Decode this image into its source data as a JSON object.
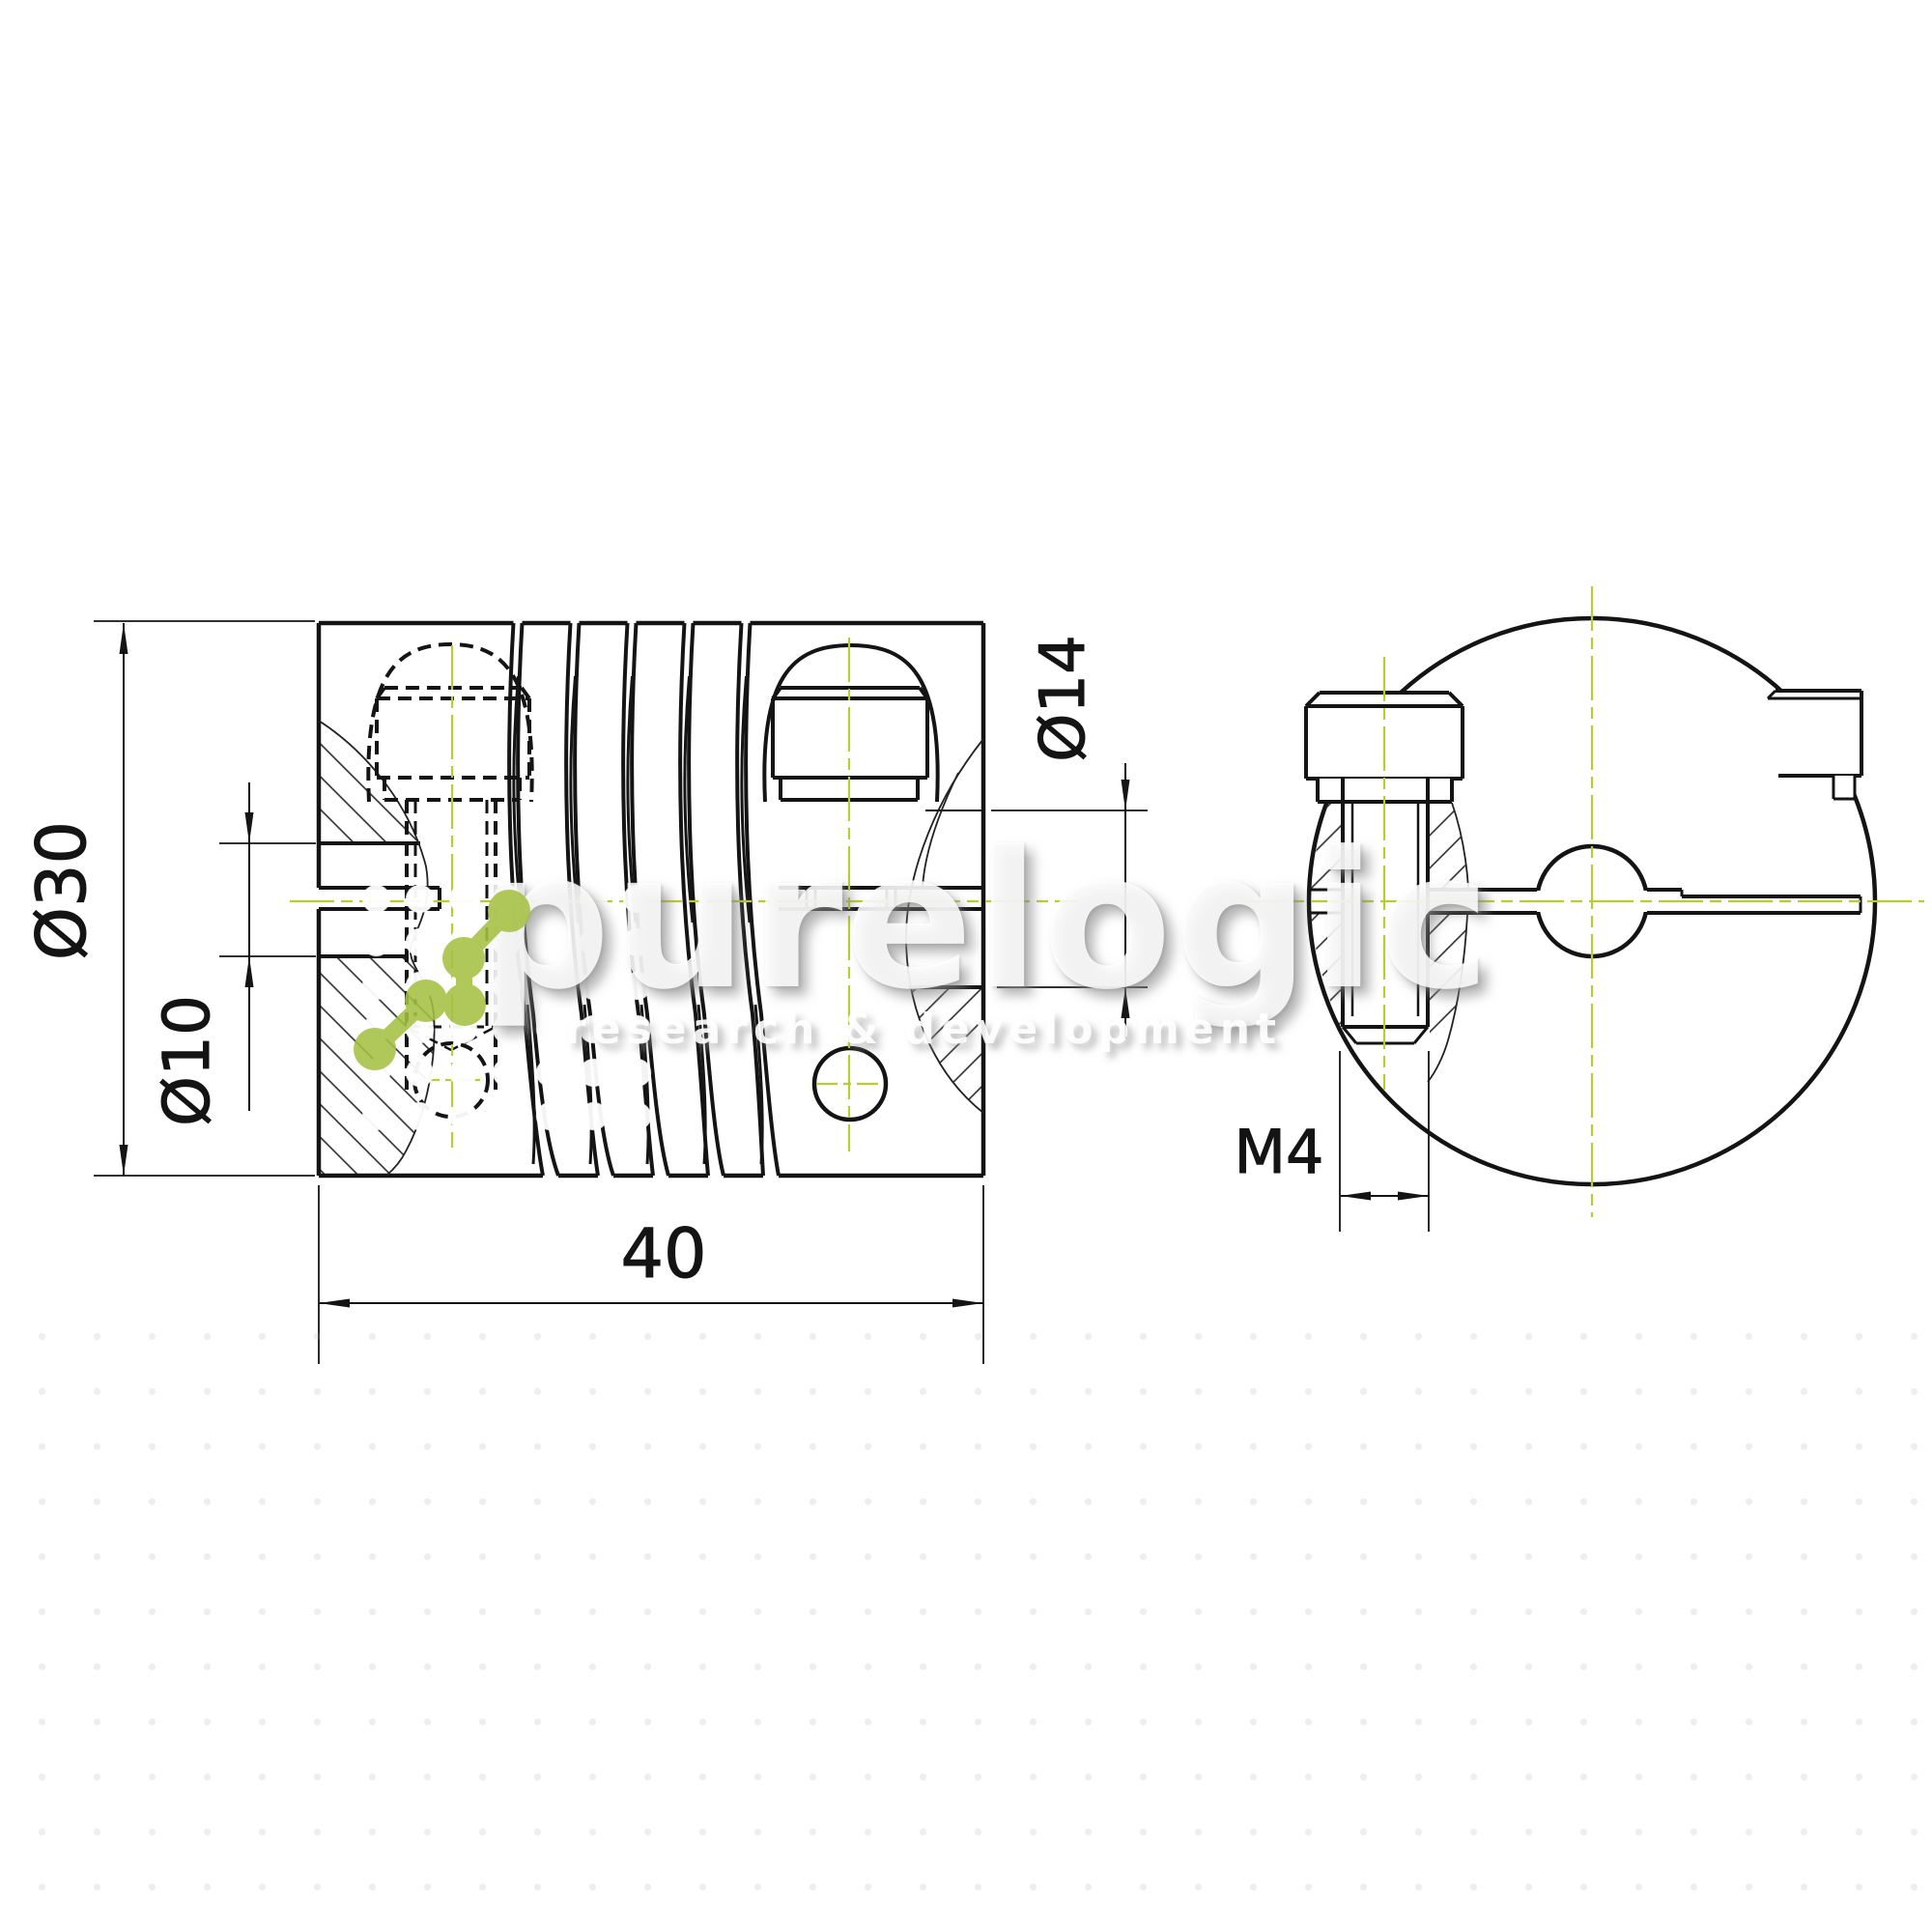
{
  "dimensions": {
    "outer_diameter": "Ø30",
    "bore_diameter": "Ø10",
    "overall_length": "40",
    "counterbore_diameter": "Ø14",
    "clamp_screw_thread": "M4"
  },
  "watermark": {
    "brand": "purelogic",
    "tagline": "research & development"
  },
  "colors": {
    "line": "#141414",
    "centerline_green": "#b9cc33",
    "logo_green": "#a6c043",
    "background": "#ffffff",
    "watermark_white": "rgba(255,255,255,0.85)"
  }
}
